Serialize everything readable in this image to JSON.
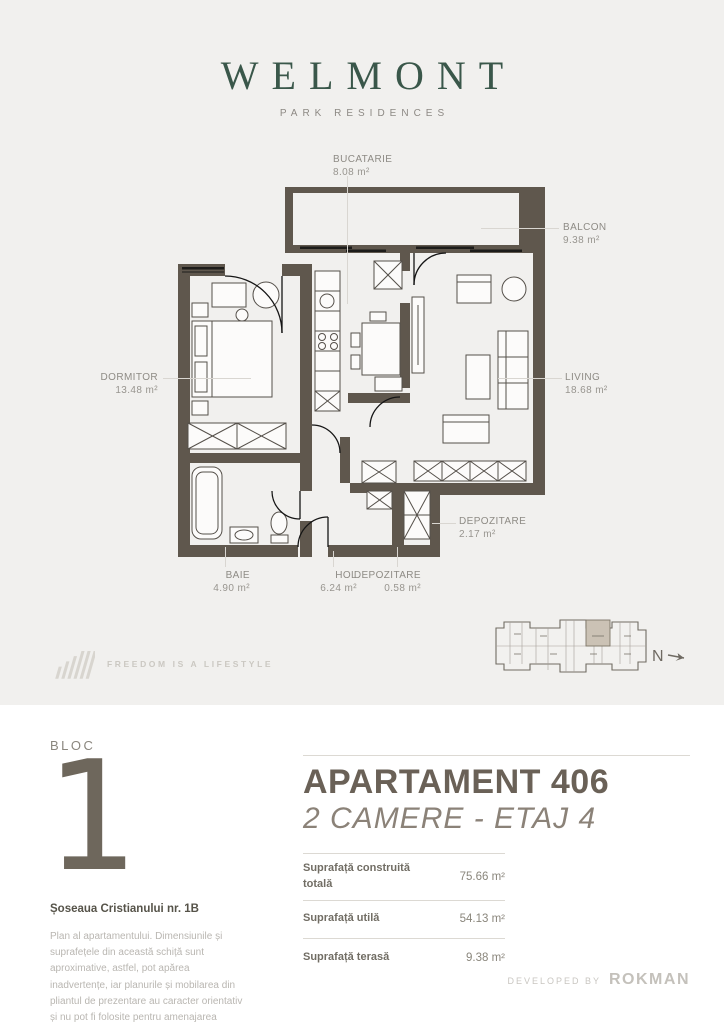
{
  "brand": {
    "name": "WELMONT",
    "tagline": "PARK RESIDENCES"
  },
  "plan": {
    "labels": [
      {
        "id": "bucatarie",
        "name": "BUCATARIE",
        "area": "8.08 m²"
      },
      {
        "id": "balcon",
        "name": "BALCON",
        "area": "9.38 m²"
      },
      {
        "id": "dormitor",
        "name": "DORMITOR",
        "area": "13.48 m²"
      },
      {
        "id": "living",
        "name": "LIVING",
        "area": "18.68 m²"
      },
      {
        "id": "depozitare-mare",
        "name": "DEPOZITARE",
        "area": "2.17 m²"
      },
      {
        "id": "baie",
        "name": "BAIE",
        "area": "4.90 m²"
      },
      {
        "id": "hol",
        "name": "HOL",
        "area": "6.24 m²"
      },
      {
        "id": "depozitare-mica",
        "name": "DEPOZITARE",
        "area": "0.58 m²"
      }
    ],
    "north_label": "N"
  },
  "sheet_footer": {
    "slogan": "FREEDOM IS A LIFESTYLE"
  },
  "details": {
    "bloc_label": "BLOC",
    "bloc_number": "1",
    "address": "Șoseaua Cristianului nr. 1B",
    "disclaimer": "Plan al apartamentului. Dimensiunile și suprafețele din această schiță sunt aproximative, astfel, pot apărea inadvertențe, iar planurile și mobilarea din pliantul de prezentare au caracter orientativ și nu pot fi folosite pentru amenajarea spațiului interior.",
    "title": "APARTAMENT 406",
    "subtitle": "2 CAMERE - ETAJ 4",
    "surfaces": [
      {
        "label": "Suprafață construită totală",
        "value": "75.66 m²"
      },
      {
        "label": "Suprafață utilă",
        "value": "54.13 m²"
      },
      {
        "label": "Suprafață terasă",
        "value": "9.38 m²"
      }
    ],
    "developed_by": "DEVELOPED BY",
    "developer": "ROKMAN"
  },
  "colors": {
    "brand_green": "#3a574a",
    "wall": "#5f574d",
    "sheet_background": "#f1f0ee",
    "label_gray": "#8e8b85",
    "minimap_highlight": "#cbc2b5"
  }
}
